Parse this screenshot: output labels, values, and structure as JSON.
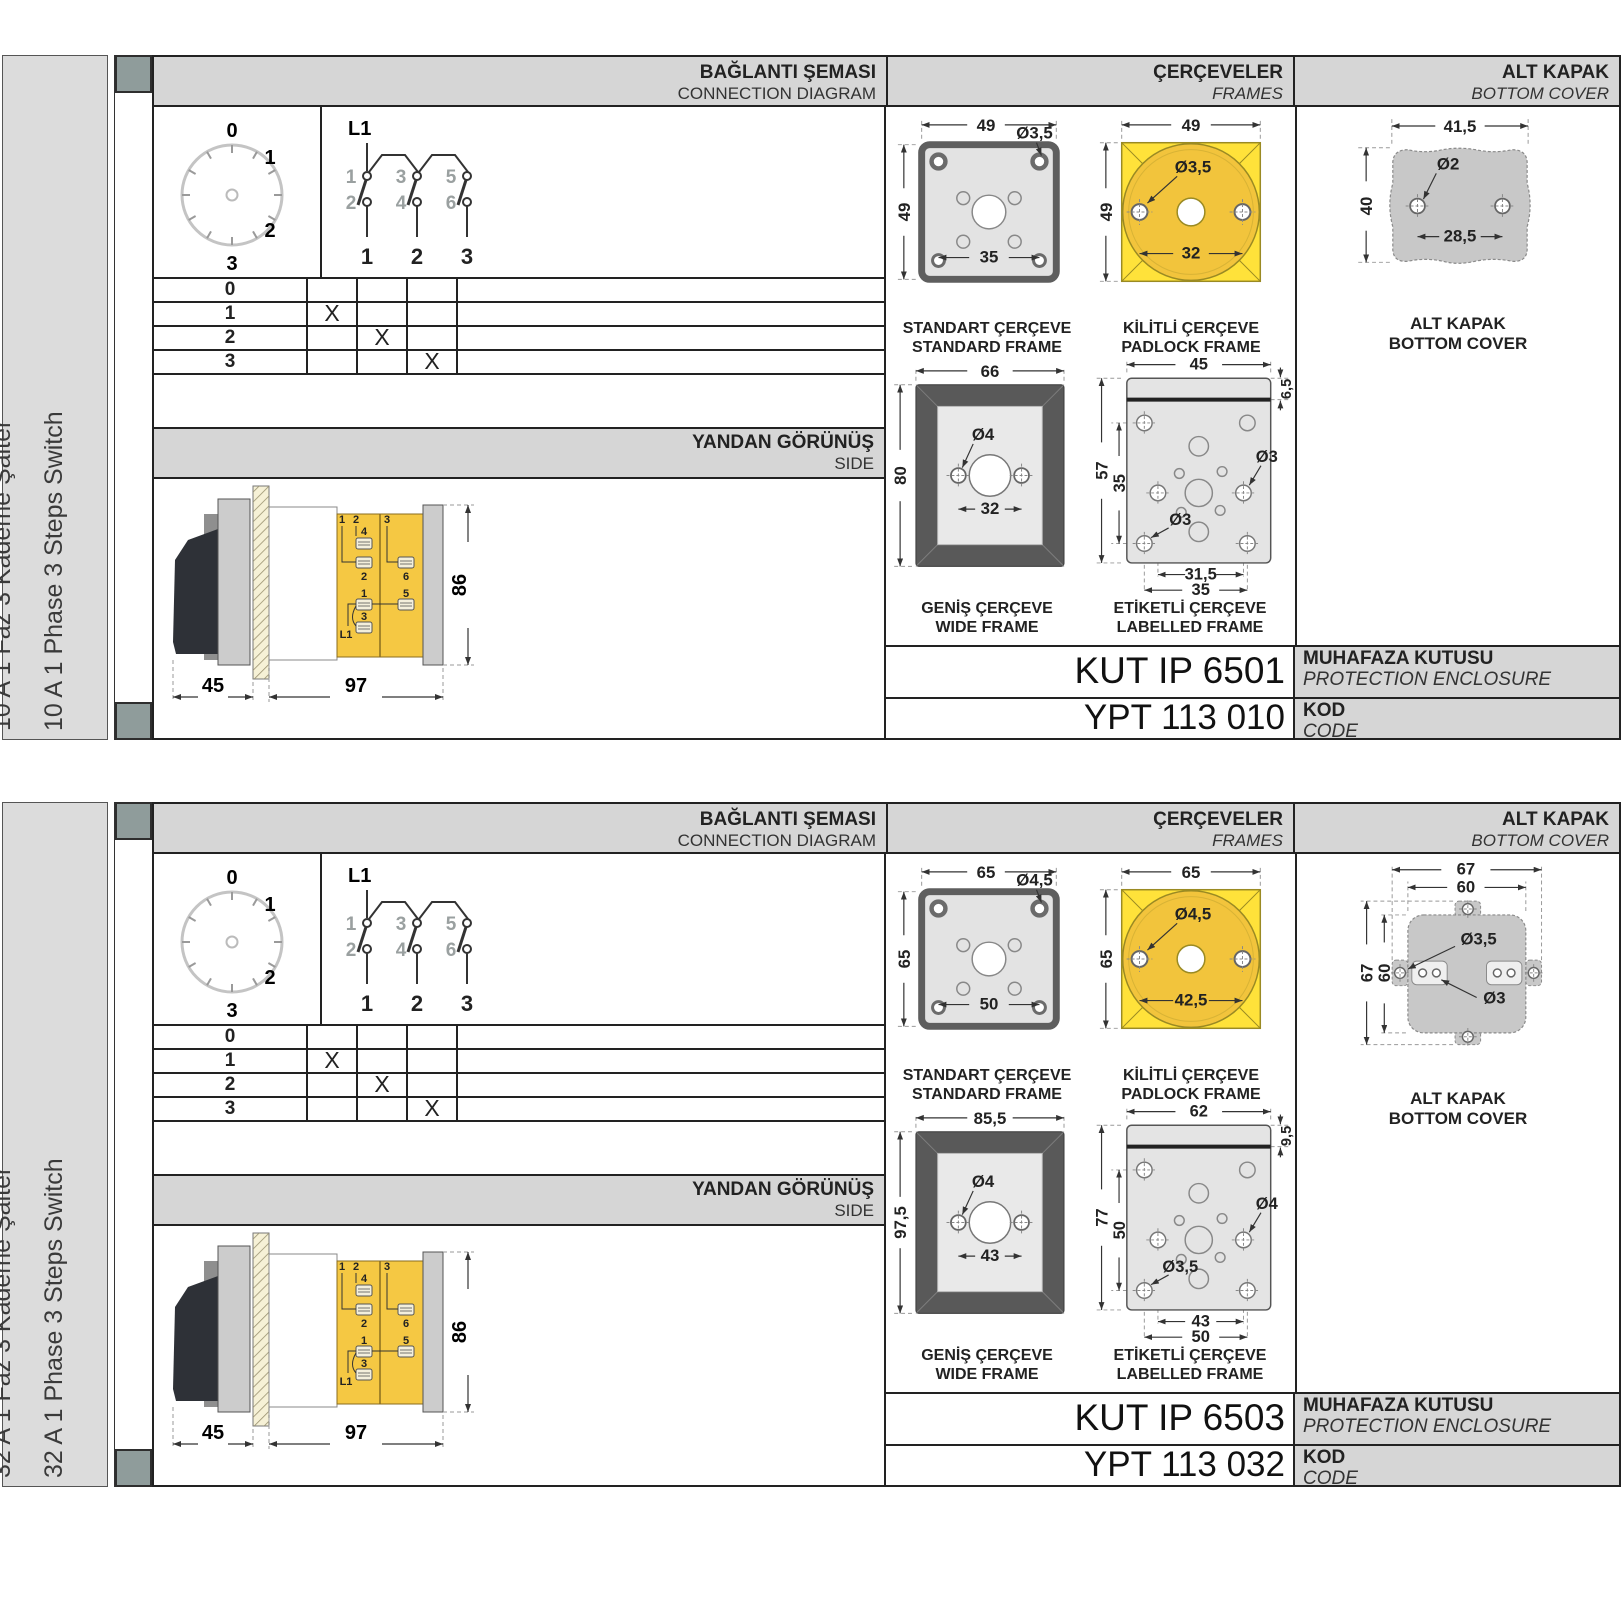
{
  "sections": [
    {
      "sidebar": {
        "line1": "10 A 1 Faz 3 Kademe Şalter",
        "line2": "10 A 1 Phase 3 Steps Switch"
      },
      "headers": {
        "connection_tr": "BAĞLANTI ŞEMASI",
        "connection_en": "CONNECTION DIAGRAM",
        "frames_tr": "ÇERÇEVELER",
        "frames_en": "FRAMES",
        "cover_tr": "ALT KAPAK",
        "cover_en": "BOTTOM COVER"
      },
      "dial": {
        "p0": "0",
        "p1": "1",
        "p2": "2",
        "p3": "3"
      },
      "contacts": {
        "l1": "L1",
        "t1": "1",
        "t3": "3",
        "t5": "5",
        "b2": "2",
        "b4": "4",
        "b6": "6",
        "n1": "1",
        "n2": "2",
        "n3": "3"
      },
      "table": {
        "r0": {
          "label": "0",
          "m1": "",
          "m2": "",
          "m3": ""
        },
        "r1": {
          "label": "1",
          "m1": "X",
          "m2": "",
          "m3": ""
        },
        "r2": {
          "label": "2",
          "m1": "",
          "m2": "X",
          "m3": ""
        },
        "r3": {
          "label": "3",
          "m1": "",
          "m2": "",
          "m3": "X"
        }
      },
      "side": {
        "title_tr": "YANDAN GÖRÜNÜŞ",
        "title_en": "SIDE",
        "dim_handle": "45",
        "dim_body": "97",
        "dim_height": "86",
        "w1": "1",
        "w2": "2",
        "w3": "3",
        "t4": "4",
        "t2": "2",
        "t6": "6",
        "t1": "1",
        "t5": "5",
        "t3": "3",
        "l1": "L1"
      },
      "std": {
        "tr": "STANDART ÇERÇEVE",
        "en": "STANDARD FRAME",
        "w": "49",
        "h": "49",
        "hole": "Ø3,5",
        "inner": "35"
      },
      "pad": {
        "tr": "KİLİTLİ ÇERÇEVE",
        "en": "PADLOCK FRAME",
        "w": "49",
        "h": "49",
        "hole": "Ø3,5",
        "inner": "32"
      },
      "wide": {
        "tr": "GENİŞ ÇERÇEVE",
        "en": "WIDE FRAME",
        "w": "66",
        "h": "80",
        "hole": "Ø4",
        "inner": "32"
      },
      "lab": {
        "tr": "ETİKETLİ ÇERÇEVE",
        "en": "LABELLED FRAME",
        "w": "45",
        "top": "6,5",
        "h": "57",
        "innerH": "35",
        "holeR": "Ø3",
        "holeL": "Ø3",
        "innerW": "31,5",
        "outerW": "35"
      },
      "cover": {
        "caption_tr": "ALT KAPAK",
        "caption_en": "BOTTOM COVER",
        "w": "41,5",
        "h": "40",
        "hole": "Ø2",
        "inner": "28,5"
      },
      "enclosure": {
        "value": "KUT IP 6501",
        "label_tr": "MUHAFAZA KUTUSU",
        "label_en": "PROTECTION ENCLOSURE"
      },
      "code": {
        "value": "YPT 113 010",
        "label_tr": "KOD",
        "label_en": "CODE"
      }
    },
    {
      "sidebar": {
        "line1": "32 A 1 Faz 3 Kademe Şalter",
        "line2": "32 A 1 Phase 3 Steps Switch"
      },
      "headers": {
        "connection_tr": "BAĞLANTI ŞEMASI",
        "connection_en": "CONNECTION DIAGRAM",
        "frames_tr": "ÇERÇEVELER",
        "frames_en": "FRAMES",
        "cover_tr": "ALT KAPAK",
        "cover_en": "BOTTOM COVER"
      },
      "dial": {
        "p0": "0",
        "p1": "1",
        "p2": "2",
        "p3": "3"
      },
      "contacts": {
        "l1": "L1",
        "t1": "1",
        "t3": "3",
        "t5": "5",
        "b2": "2",
        "b4": "4",
        "b6": "6",
        "n1": "1",
        "n2": "2",
        "n3": "3"
      },
      "table": {
        "r0": {
          "label": "0",
          "m1": "",
          "m2": "",
          "m3": ""
        },
        "r1": {
          "label": "1",
          "m1": "X",
          "m2": "",
          "m3": ""
        },
        "r2": {
          "label": "2",
          "m1": "",
          "m2": "X",
          "m3": ""
        },
        "r3": {
          "label": "3",
          "m1": "",
          "m2": "",
          "m3": "X"
        }
      },
      "side": {
        "title_tr": "YANDAN GÖRÜNÜŞ",
        "title_en": "SIDE",
        "dim_handle": "45",
        "dim_body": "97",
        "dim_height": "86",
        "w1": "1",
        "w2": "2",
        "w3": "3",
        "t4": "4",
        "t2": "2",
        "t6": "6",
        "t1": "1",
        "t5": "5",
        "t3": "3",
        "l1": "L1"
      },
      "std": {
        "tr": "STANDART ÇERÇEVE",
        "en": "STANDARD FRAME",
        "w": "65",
        "h": "65",
        "hole": "Ø4,5",
        "inner": "50"
      },
      "pad": {
        "tr": "KİLİTLİ ÇERÇEVE",
        "en": "PADLOCK FRAME",
        "w": "65",
        "h": "65",
        "hole": "Ø4,5",
        "inner": "42,5"
      },
      "wide": {
        "tr": "GENİŞ ÇERÇEVE",
        "en": "WIDE FRAME",
        "w": "85,5",
        "h": "97,5",
        "hole": "Ø4",
        "inner": "43"
      },
      "lab": {
        "tr": "ETİKETLİ ÇERÇEVE",
        "en": "LABELLED FRAME",
        "w": "62",
        "top": "9,5",
        "h": "77",
        "innerH": "50",
        "holeR": "Ø4",
        "holeL": "Ø3,5",
        "innerW": "43",
        "outerW": "50"
      },
      "cover": {
        "caption_tr": "ALT KAPAK",
        "caption_en": "BOTTOM COVER",
        "w1": "67",
        "w2": "60",
        "h1": "67",
        "h2": "60",
        "hole1": "Ø3,5",
        "hole2": "Ø3"
      },
      "enclosure": {
        "value": "KUT IP 6503",
        "label_tr": "MUHAFAZA KUTUSU",
        "label_en": "PROTECTION ENCLOSURE"
      },
      "code": {
        "value": "YPT 113 032",
        "label_tr": "KOD",
        "label_en": "CODE"
      }
    }
  ]
}
